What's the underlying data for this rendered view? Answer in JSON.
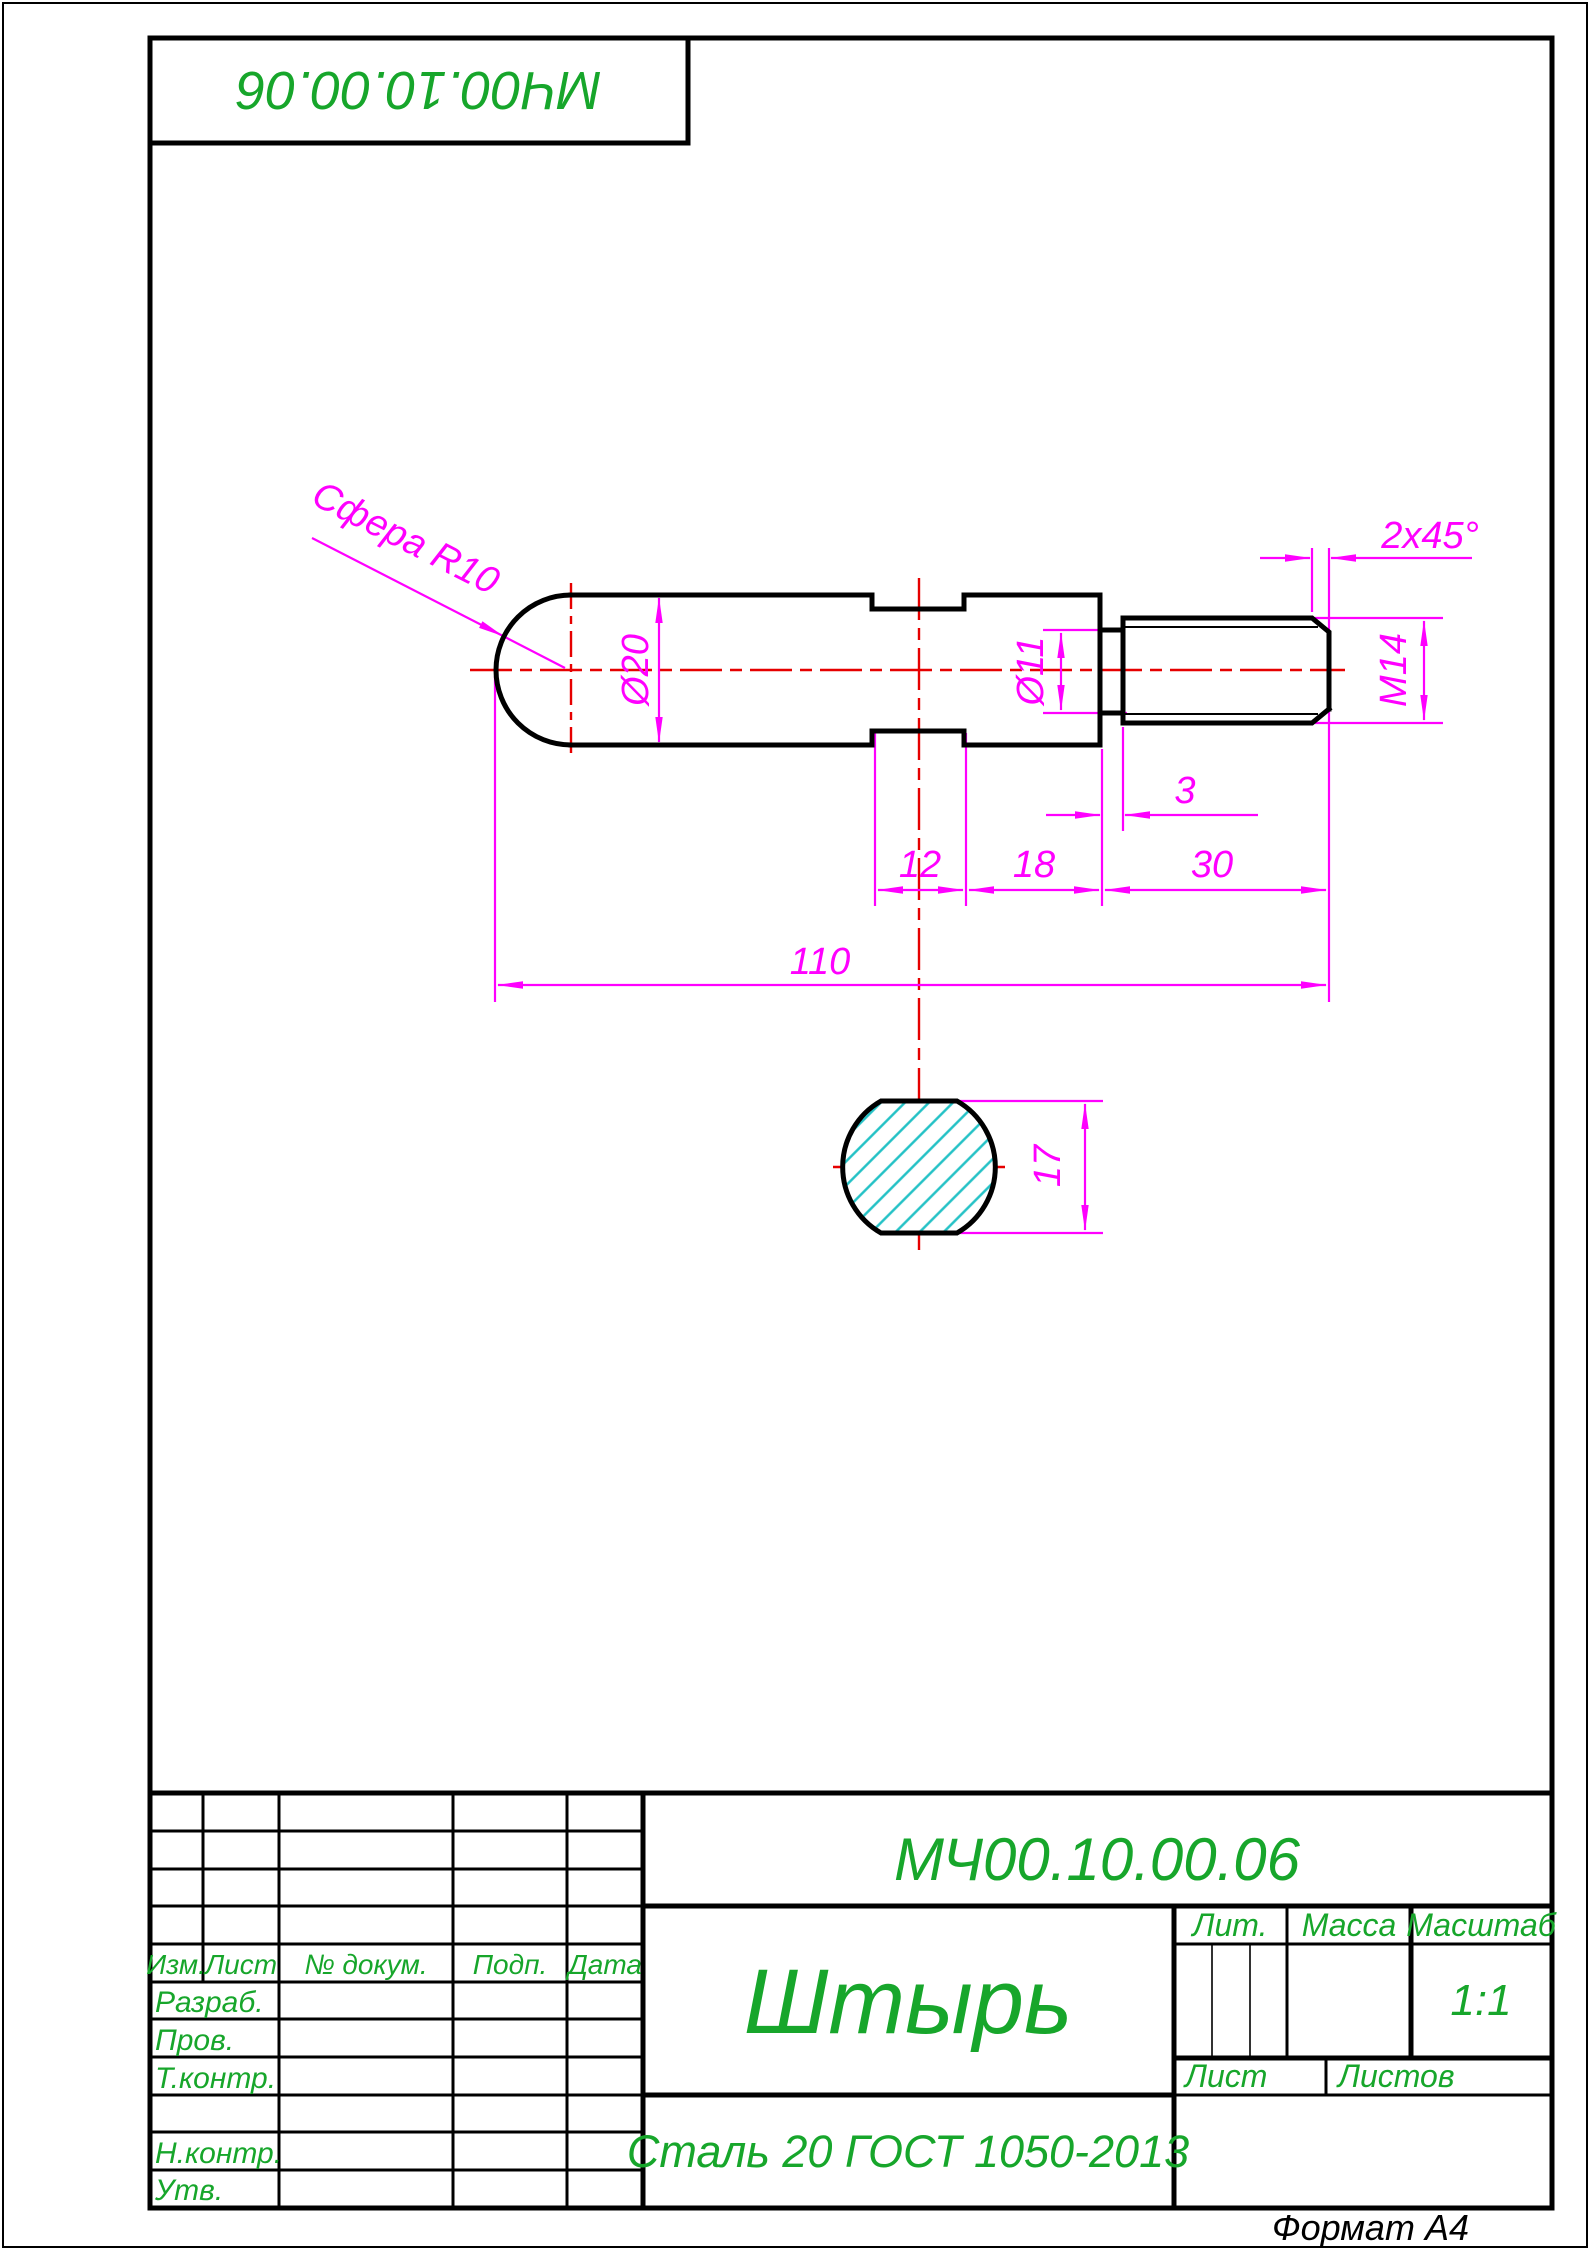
{
  "colors": {
    "outline": "#000000",
    "dimension": "#ff00ff",
    "centerline": "#e60000",
    "hatch": "#25c2c6",
    "stamp_text": "#17a62b"
  },
  "corner_stamp": {
    "designation": "МЧ00.10.00.06"
  },
  "drawing": {
    "labels": {
      "sphere_note": "Сфера R10",
      "d20": "Ø20",
      "d11": "Ø11",
      "m14": "М14",
      "chamfer": "2x45°",
      "len3": "3",
      "len12": "12",
      "len18": "18",
      "len30": "30",
      "len110": "110",
      "width17": "17"
    }
  },
  "title_block": {
    "designation": "МЧ00.10.00.06",
    "part_name": "Штырь",
    "material": "Сталь 20 ГОСТ 1050-2013",
    "scale_value": "1:1",
    "headers": {
      "izm": "Изм.",
      "list": "Лист",
      "doc_num": "№ докум.",
      "podp": "Подп.",
      "data": "Дата",
      "lit": "Лит.",
      "massa": "Масса",
      "masshtab": "Масштаб",
      "sheet": "Лист",
      "sheets": "Листов"
    },
    "rows": {
      "razrab": "Разраб.",
      "prov": "Пров.",
      "tkontr": "Т.контр.",
      "nkontr": "Н.контр.",
      "utv": "Утв."
    }
  },
  "page": {
    "format_label": "Формат А4"
  }
}
